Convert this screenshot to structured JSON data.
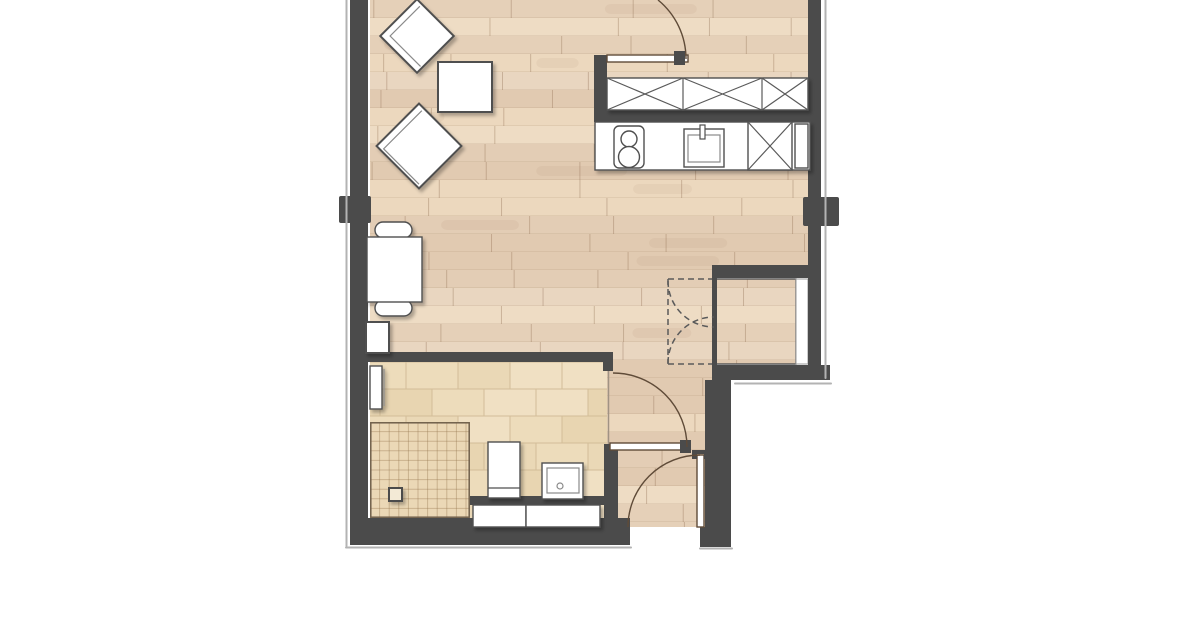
{
  "document": {
    "type": "architectural-floor-plan",
    "text_labels": [],
    "background": "#ffffff"
  },
  "colors": {
    "wall": "#4b4b4b",
    "wallShadow": "#b3b3b3",
    "doorStroke": "#5f4b38",
    "dashedDoor": "#5a5a5a",
    "fixtureFill": "#ffffff",
    "fixtureStroke": "#4f4f4f",
    "windowFill": "#ffffff",
    "windowStroke": "#9a9a9a",
    "woodSeam": "rgba(150,118,90,0.40)",
    "woodRowLine": "rgba(160,128,100,0.30)",
    "tileGrout": "#d2bd98",
    "showerGridLine": "rgba(150,120,80,0.40)",
    "showerOutline": "#70604c",
    "nicheOutline": "#5a5a5a"
  },
  "palettes": {
    "wood": [
      "#e9d6c0",
      "#e3cdb5",
      "#eedcc4",
      "#e5d0b8",
      "#ecd8be",
      "#e1cab1"
    ],
    "tile": [
      "#eddcbb",
      "#e8d5b1",
      "#f0e0c3",
      "#ead8b6"
    ],
    "showerBase": "#ebd8b6"
  },
  "rooms": [
    {
      "name": "living-area",
      "floor": "wood"
    },
    {
      "name": "kitchen-strip",
      "floor": "wood"
    },
    {
      "name": "bathroom",
      "floor": "tile"
    },
    {
      "name": "entry-corridor",
      "floor": "wood"
    },
    {
      "name": "wardrobe-niche",
      "floor": "wood"
    }
  ],
  "furniture": {
    "armchair_1": "rotated armchair",
    "armchair_2": "rotated armchair",
    "side_table": "square side table",
    "dining_table": "table with two chairs",
    "radiator_living": "radiator under wall",
    "wall_cabinets": "3 overhead cabinets (X symbol)",
    "counter": "kitchen counter",
    "stove": "cooktop with 2 burners",
    "kitchen_sink": "sink with faucet",
    "dishwasher": "appliance (X symbol)",
    "toilet": "toilet",
    "washbasin": "washbasin with drain",
    "bath_cabinets": "2 base cabinets",
    "shower": "tiled shower with drain",
    "radiator_bath": "towel radiator"
  },
  "doors": {
    "top_door": "swing door, upper hall",
    "bathroom_door": "swing door into corridor",
    "entry_door": "apartment entry door, bottom",
    "wardrobe_doors": "double doors shown dashed"
  }
}
